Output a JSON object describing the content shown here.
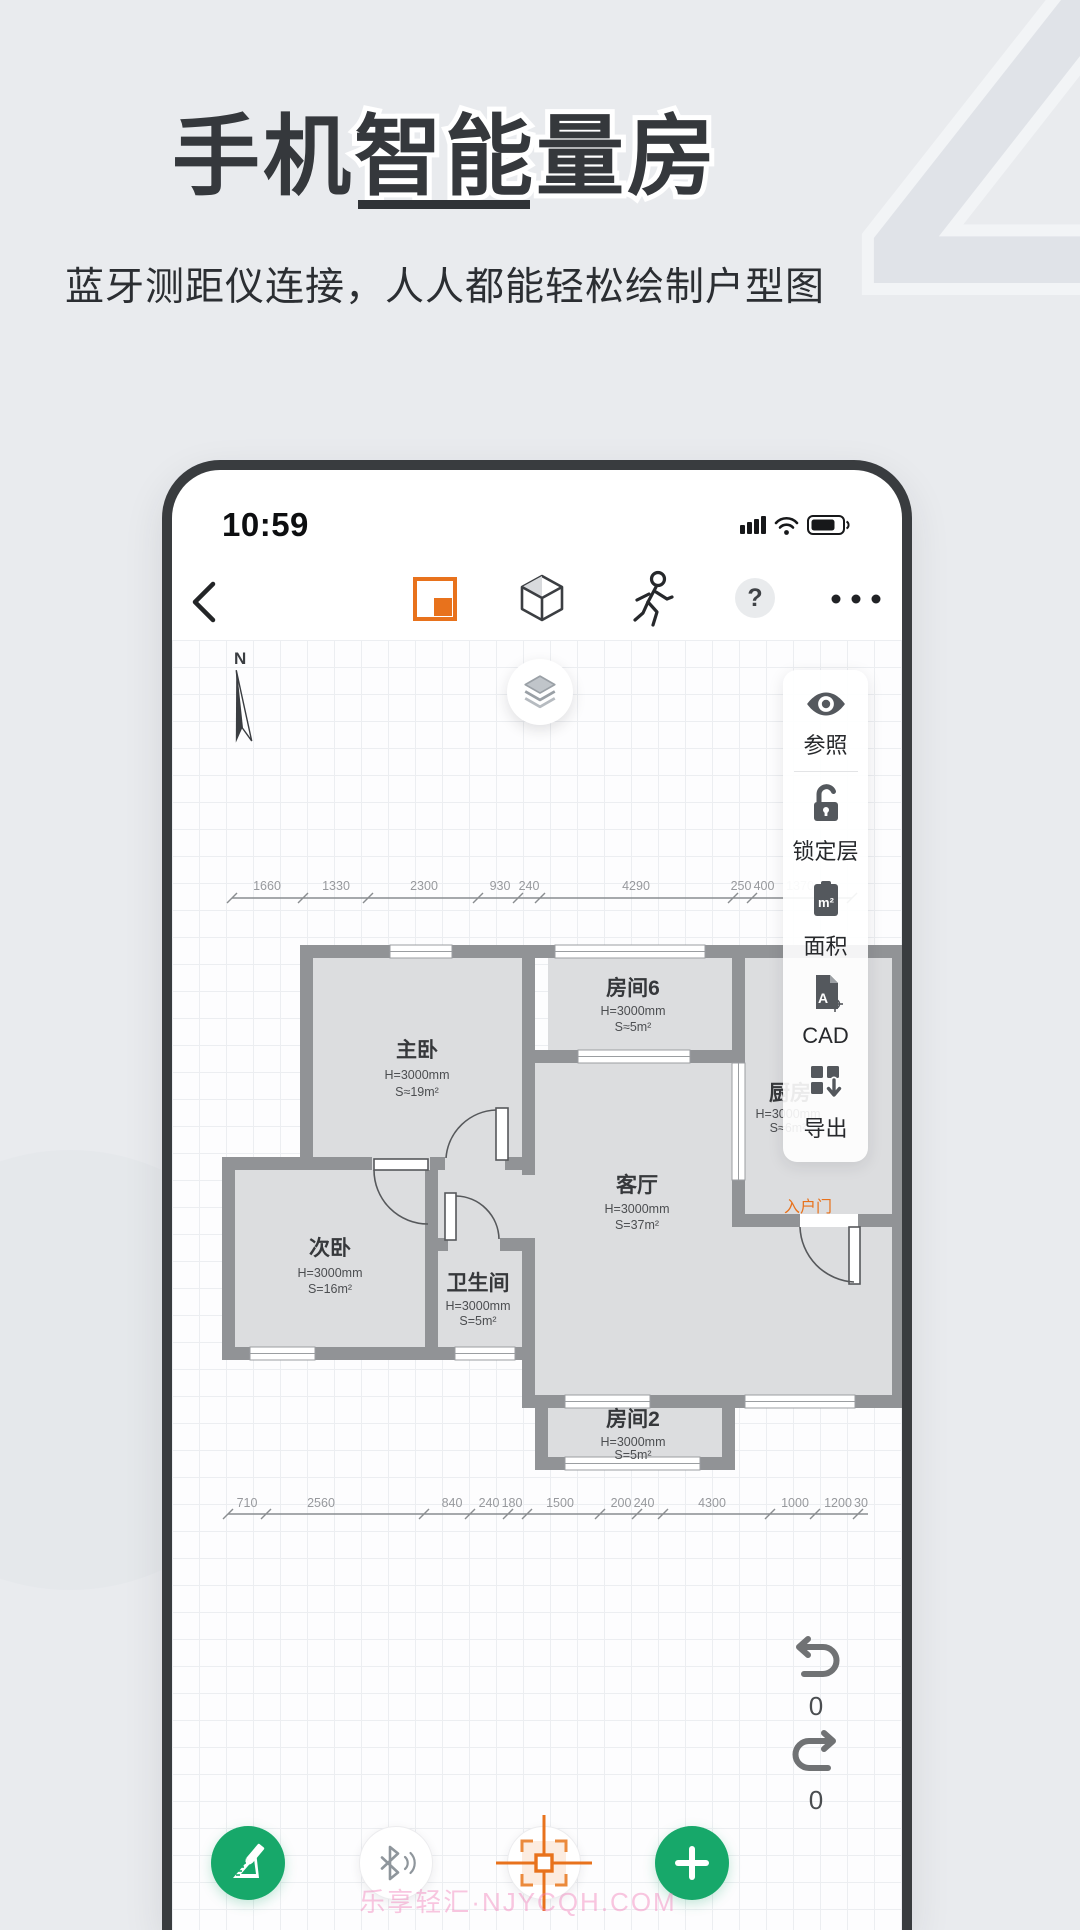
{
  "hero": {
    "title_solid": "手机",
    "title_outline": "智能量房",
    "subtitle": "蓝牙测距仪连接，人人都能轻松绘制户型图"
  },
  "phone": {
    "status": {
      "time": "10:59"
    },
    "toolbar": {
      "help_label": "?",
      "icons": [
        "back-chevron",
        "floorplan-2d",
        "cube-3d",
        "walk-roam",
        "help",
        "more-ellipsis"
      ]
    },
    "canvas": {
      "compass": "N",
      "sidebar": [
        {
          "label": "参照",
          "icon": "eye"
        },
        {
          "label": "锁定层",
          "icon": "lock-open"
        },
        {
          "label": "面积",
          "icon": "area-clipboard"
        },
        {
          "label": "CAD",
          "icon": "cad-file"
        },
        {
          "label": "导出",
          "icon": "export-down"
        }
      ],
      "icon_glyphs": {
        "area_text": "m²",
        "cad_text": "A"
      },
      "rooms": [
        {
          "name": "主卧",
          "h": "H=3000mm",
          "s": "S≈19m²"
        },
        {
          "name": "房间6",
          "h": "H=3000mm",
          "s": "S≈5m²"
        },
        {
          "name": "客厅",
          "h": "H=3000mm",
          "s": "S=37m²"
        },
        {
          "name": "厨房",
          "h": "H=3000mm",
          "s": "S≈6m²"
        },
        {
          "name": "次卧",
          "h": "H=3000mm",
          "s": "S=16m²"
        },
        {
          "name": "卫生间",
          "h": "H=3000mm",
          "s": "S=5m²"
        },
        {
          "name": "房间2",
          "h": "H=3000mm",
          "s": "S=5m²"
        }
      ],
      "entry_label": "入户门",
      "dims_top": [
        "1660",
        "1330",
        "2300",
        "930",
        "240",
        "4290",
        "250",
        "400",
        "1370"
      ],
      "dims_bottom": [
        "710",
        "2560",
        "840",
        "240",
        "180",
        "1500",
        "200",
        "240",
        "4300",
        "1000",
        "1200",
        "30"
      ],
      "undo_count": "0",
      "redo_count": "0"
    },
    "fab_icons": [
      "ruler-pencil",
      "bluetooth-signal",
      "snap-target",
      "add-plus"
    ]
  },
  "watermark": {
    "text": "乐享轻汇·NJYCQH.COM"
  },
  "colors": {
    "accent_orange": "#e8721c",
    "green": "#17a86a",
    "wall_gray": "#919396",
    "room_fill": "#dcdddf",
    "frame_dark": "#393c3f",
    "background": "#e9ebee"
  }
}
